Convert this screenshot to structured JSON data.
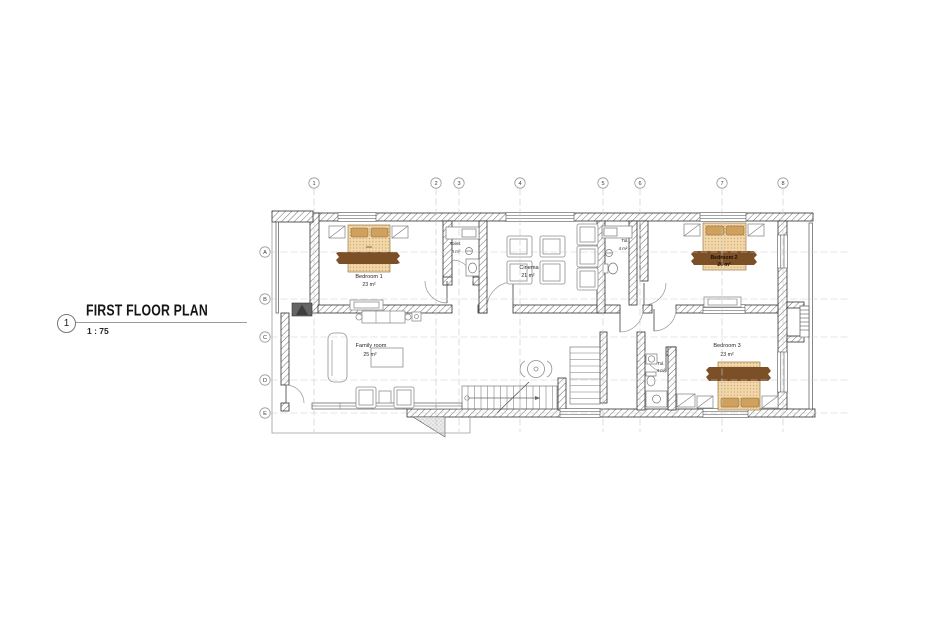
{
  "title_block": {
    "number": "1",
    "title": "FIRST FLOOR PLAN",
    "scale": "1 : 75"
  },
  "grid": {
    "columns": [
      "1",
      "2",
      "3",
      "4",
      "5",
      "6",
      "7",
      "8"
    ],
    "rows": [
      "A",
      "B",
      "C",
      "D",
      "E"
    ]
  },
  "rooms": {
    "bedroom1": {
      "name": "Bedroom 1",
      "area": "23 m²"
    },
    "toilet_top": {
      "name": "Toilet",
      "area": "4 m²"
    },
    "cinema": {
      "name": "Cinema",
      "area": "21 m²"
    },
    "toilet_mid": {
      "name": "Tol.",
      "area": "4 m²"
    },
    "bedroom2": {
      "name": "Bedroom 2",
      "area": "26 m²"
    },
    "family_room": {
      "name": "Family room",
      "area": "25 m²"
    },
    "toilet_lower": {
      "name": "Tol.",
      "area": "4 m²"
    },
    "bedroom3": {
      "name": "Bedroom 3",
      "area": "23 m²"
    }
  },
  "colors": {
    "bed_fill": "#f2d7aa",
    "bed_pillow": "#cfa05e",
    "bed_blanket": "#7c5026",
    "fireplace": "#646464"
  }
}
